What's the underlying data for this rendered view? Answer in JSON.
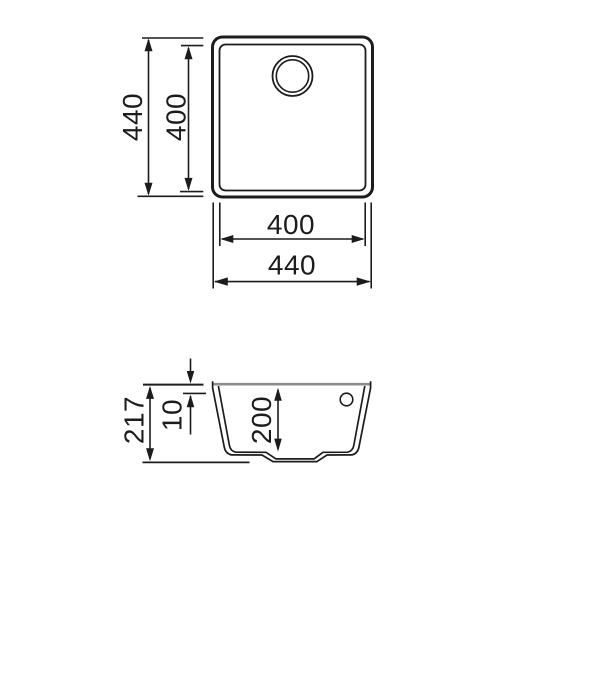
{
  "drawing": {
    "description": "Undermount square sink technical drawing, plan view and sectional side view with millimetre dimensions",
    "line_color": "#1c1c1c",
    "rim_line_color": "#8c8c8c",
    "background_color": "#ffffff",
    "top_view": {
      "dim_overall_height": "440",
      "dim_bowl_height": "400",
      "dim_bowl_width": "400",
      "dim_overall_width": "440"
    },
    "side_view": {
      "dim_total_height": "217",
      "dim_rim_thickness": "10",
      "dim_bowl_depth": "200"
    }
  }
}
